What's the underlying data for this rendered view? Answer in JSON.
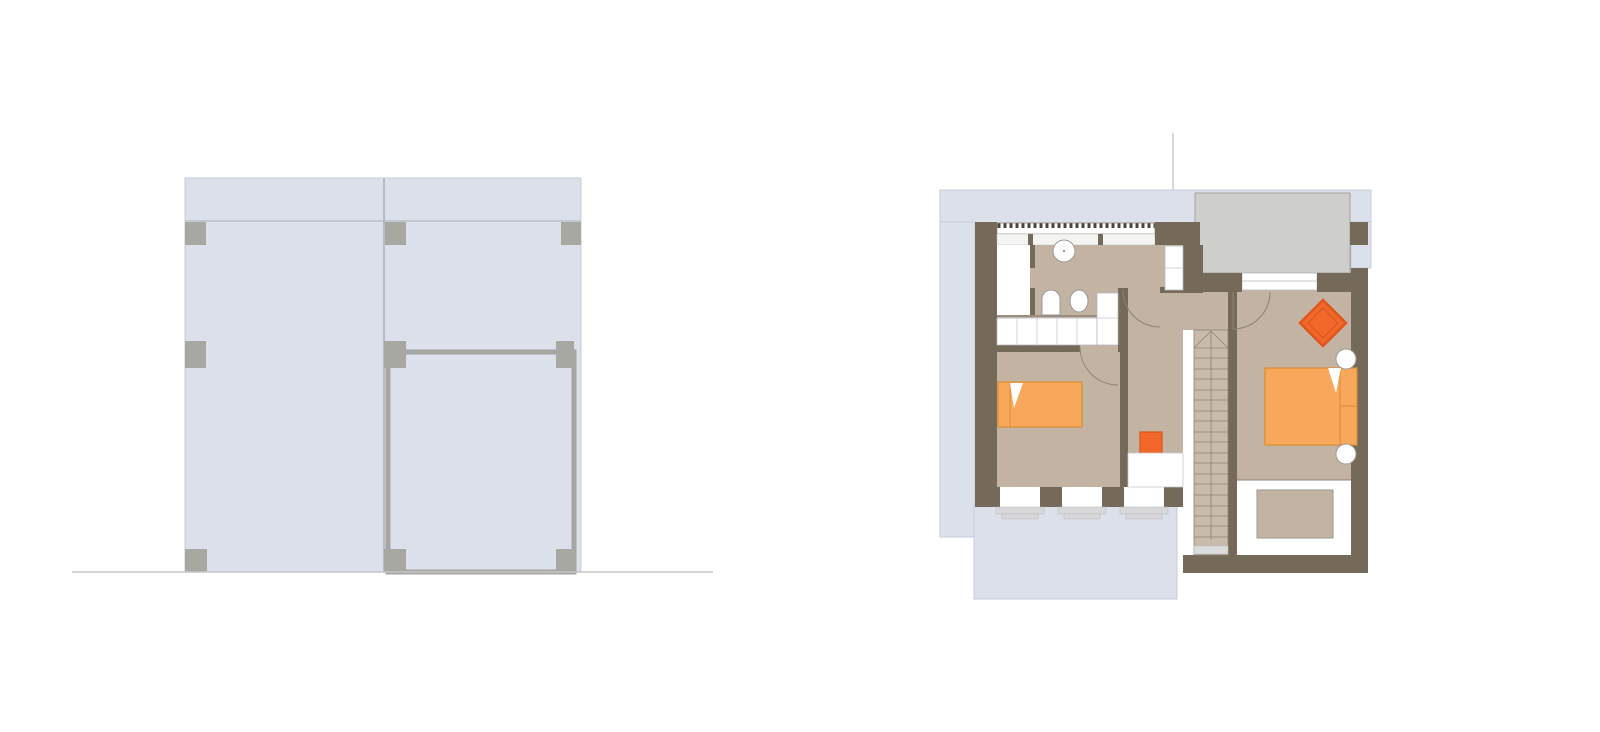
{
  "canvas": {
    "width": 1600,
    "height": 732,
    "background": "#ffffff"
  },
  "palette": {
    "blue": "#dbe0ea",
    "blueStroke": "#c6ccd9",
    "wall": "#75695a",
    "floor": "#c2b3a3",
    "stair": "#c9bbab",
    "terrace": "#cecfca",
    "terraceStroke": "#a3a39e",
    "white": "#ffffff",
    "sillGray": "#d8d8db",
    "squareGray": "#a8a8a3",
    "bedOrange": "#f7a85b",
    "bedStroke": "#de8c31",
    "brightOrange": "#f2672a",
    "brightStroke": "#d9551b",
    "thinLine": "#8d8276",
    "lightLine": "#c9c9cc",
    "fixtureStroke": "#9a9a96",
    "groundLine": "#c6c6c6",
    "frameGray": "#a6a6a2",
    "panelLine": "#a9aeb9"
  },
  "elevation": {
    "name": "building-elevation",
    "shapes": [
      {
        "n": "facade-body",
        "t": "rect",
        "x": 185,
        "y": 178,
        "w": 396,
        "h": 394,
        "f": "$blue",
        "s": "$blueStroke",
        "sw": 1
      },
      {
        "n": "facade-top-band-line",
        "t": "line",
        "x1": 185,
        "y1": 221,
        "x2": 581,
        "y2": 221,
        "s": "$panelLine",
        "sw": 1
      },
      {
        "n": "facade-panel-divider",
        "t": "line",
        "x1": 384,
        "y1": 178,
        "x2": 384,
        "y2": 572,
        "s": "$panelLine",
        "sw": 1.5
      },
      {
        "n": "facade-door-frame",
        "t": "rect",
        "x": 388,
        "y": 352,
        "w": 186,
        "h": 220,
        "f": "none",
        "s": "$frameGray",
        "sw": 5
      },
      {
        "n": "connector-square-top-left",
        "t": "rect",
        "x": 185,
        "y": 222,
        "w": 21,
        "h": 23,
        "f": "$squareGray"
      },
      {
        "n": "connector-square-top-mid",
        "t": "rect",
        "x": 385,
        "y": 222,
        "w": 21,
        "h": 23,
        "f": "$squareGray"
      },
      {
        "n": "connector-square-top-right",
        "t": "rect",
        "x": 561,
        "y": 222,
        "w": 20,
        "h": 23,
        "f": "$squareGray"
      },
      {
        "n": "connector-square-mid-left",
        "t": "rect",
        "x": 185,
        "y": 341,
        "w": 21,
        "h": 27,
        "f": "$squareGray"
      },
      {
        "n": "connector-square-mid-center",
        "t": "rect",
        "x": 384,
        "y": 341,
        "w": 22,
        "h": 27,
        "f": "$squareGray"
      },
      {
        "n": "connector-square-mid-right",
        "t": "rect",
        "x": 556,
        "y": 341,
        "w": 18,
        "h": 27,
        "f": "$squareGray"
      },
      {
        "n": "connector-square-bottom-left",
        "t": "rect",
        "x": 185,
        "y": 549,
        "w": 22,
        "h": 23,
        "f": "$squareGray"
      },
      {
        "n": "connector-square-bottom-center",
        "t": "rect",
        "x": 384,
        "y": 549,
        "w": 22,
        "h": 23,
        "f": "$squareGray"
      },
      {
        "n": "connector-square-bottom-right",
        "t": "rect",
        "x": 556,
        "y": 549,
        "w": 18,
        "h": 23,
        "f": "$squareGray"
      },
      {
        "n": "ground-line",
        "t": "line",
        "x1": 72,
        "y1": 572,
        "x2": 713,
        "y2": 572,
        "s": "$groundLine",
        "sw": 1.5
      }
    ]
  },
  "floor_plan": {
    "name": "attic-floor-plan",
    "shapes": [
      {
        "n": "roof-top-band",
        "t": "rect",
        "x": 940,
        "y": 190,
        "w": 431,
        "h": 33,
        "f": "$blue",
        "s": "$blueStroke",
        "sw": 1
      },
      {
        "n": "roof-left-column",
        "t": "rect",
        "x": 940,
        "y": 222,
        "w": 35,
        "h": 315,
        "f": "$blue",
        "s": "$blueStroke",
        "sw": 1
      },
      {
        "n": "roof-right-column",
        "t": "rect",
        "x": 1351,
        "y": 222,
        "w": 20,
        "h": 46,
        "f": "$blue",
        "s": "$blueStroke",
        "sw": 1
      },
      {
        "n": "roof-bottom-apron",
        "t": "rect",
        "x": 974,
        "y": 505,
        "w": 203,
        "h": 94,
        "f": "$blue",
        "s": "$blueStroke",
        "sw": 1
      },
      {
        "n": "survey-line",
        "t": "line",
        "x1": 1173,
        "y1": 133,
        "x2": 1173,
        "y2": 190,
        "s": "#c9cdd6",
        "sw": 1.5
      },
      {
        "n": "floor-main",
        "t": "rect",
        "x": 997,
        "y": 236,
        "w": 354,
        "h": 251,
        "f": "$floor"
      },
      {
        "n": "terrace",
        "t": "rect",
        "x": 1195,
        "y": 193,
        "w": 155,
        "h": 80,
        "f": "$terrace",
        "s": "$terraceStroke",
        "sw": 1
      },
      {
        "n": "terrace-door-sill",
        "t": "rect",
        "x": 1242,
        "y": 273,
        "w": 75,
        "h": 17,
        "f": "$white",
        "s": "#b9b9bc",
        "sw": 0.75
      },
      {
        "n": "terrace-door-line",
        "t": "line",
        "x1": 1242,
        "y1": 281,
        "x2": 1317,
        "y2": 281,
        "s": "$lightLine",
        "sw": 1
      },
      {
        "n": "wall-top-left-pier",
        "t": "rect",
        "x": 975,
        "y": 222,
        "w": 22,
        "h": 23,
        "f": "$wall"
      },
      {
        "n": "wall-top-hatch",
        "t": "rect",
        "x": 997,
        "y": 223,
        "w": 158,
        "h": 11,
        "f": "url(#hatch)",
        "s": "$thinLine",
        "sw": 0.75
      },
      {
        "n": "wall-top-sill",
        "t": "rect",
        "x": 997,
        "y": 234,
        "w": 158,
        "h": 11,
        "f": "#f4f4f2",
        "s": "#b9b9bc",
        "sw": 0.5
      },
      {
        "n": "sill-stub-1",
        "t": "rect",
        "x": 1028,
        "y": 234,
        "w": 5,
        "h": 11,
        "f": "$wall"
      },
      {
        "n": "sill-stub-2",
        "t": "rect",
        "x": 1098,
        "y": 234,
        "w": 5,
        "h": 11,
        "f": "$wall"
      },
      {
        "n": "wall-top-right-pier",
        "t": "rect",
        "x": 1155,
        "y": 222,
        "w": 45,
        "h": 23,
        "f": "$wall"
      },
      {
        "n": "wall-left",
        "t": "rect",
        "x": 975,
        "y": 245,
        "w": 22,
        "h": 242,
        "f": "$wall"
      },
      {
        "n": "wall-hall-pier",
        "t": "rect",
        "x": 1183,
        "y": 245,
        "w": 20,
        "h": 48,
        "f": "$wall"
      },
      {
        "n": "wall-under-terrace-left",
        "t": "rect",
        "x": 1200,
        "y": 273,
        "w": 42,
        "h": 19,
        "f": "$wall"
      },
      {
        "n": "wall-under-terrace-right",
        "t": "rect",
        "x": 1317,
        "y": 273,
        "w": 51,
        "h": 19,
        "f": "$wall"
      },
      {
        "n": "wall-right-pier-top",
        "t": "rect",
        "x": 1350,
        "y": 222,
        "w": 18,
        "h": 23,
        "f": "$wall"
      },
      {
        "n": "wall-right",
        "t": "rect",
        "x": 1351,
        "y": 268,
        "w": 17,
        "h": 305,
        "f": "$wall"
      },
      {
        "n": "wall-bottom-under-stairs",
        "t": "rect",
        "x": 1183,
        "y": 555,
        "w": 185,
        "h": 18,
        "f": "$wall"
      },
      {
        "n": "wall-stair-right",
        "t": "rect",
        "x": 1228,
        "y": 290,
        "w": 9,
        "h": 265,
        "f": "$wall"
      },
      {
        "n": "wall-bottom-left",
        "t": "rect",
        "x": 975,
        "y": 487,
        "w": 208,
        "h": 20,
        "f": "$wall"
      },
      {
        "n": "window-1",
        "t": "rect",
        "x": 1000,
        "y": 487,
        "w": 40,
        "h": 20,
        "f": "$white"
      },
      {
        "n": "window-1-sill",
        "t": "rect",
        "x": 996,
        "y": 507,
        "w": 48,
        "h": 7,
        "f": "$sillGray",
        "s": "#b5b5b8",
        "sw": 0.5
      },
      {
        "n": "window-1-sill-step",
        "t": "rect",
        "x": 1002,
        "y": 514,
        "w": 36,
        "h": 5,
        "f": "$sillGray",
        "s": "#b5b5b8",
        "sw": 0.5
      },
      {
        "n": "window-2",
        "t": "rect",
        "x": 1062,
        "y": 487,
        "w": 40,
        "h": 20,
        "f": "$white"
      },
      {
        "n": "window-2-sill",
        "t": "rect",
        "x": 1058,
        "y": 507,
        "w": 48,
        "h": 7,
        "f": "$sillGray",
        "s": "#b5b5b8",
        "sw": 0.5
      },
      {
        "n": "window-2-sill-step",
        "t": "rect",
        "x": 1064,
        "y": 514,
        "w": 36,
        "h": 5,
        "f": "$sillGray",
        "s": "#b5b5b8",
        "sw": 0.5
      },
      {
        "n": "window-3",
        "t": "rect",
        "x": 1124,
        "y": 487,
        "w": 40,
        "h": 20,
        "f": "$white"
      },
      {
        "n": "window-3-sill",
        "t": "rect",
        "x": 1120,
        "y": 507,
        "w": 48,
        "h": 7,
        "f": "$sillGray",
        "s": "#b5b5b8",
        "sw": 0.5
      },
      {
        "n": "window-3-sill-step",
        "t": "rect",
        "x": 1126,
        "y": 514,
        "w": 36,
        "h": 5,
        "f": "$sillGray",
        "s": "#b5b5b8",
        "sw": 0.5
      },
      {
        "n": "wall-bedroom1-top-a",
        "t": "rect",
        "x": 975,
        "y": 345,
        "w": 105,
        "h": 7,
        "f": "$wall"
      },
      {
        "n": "wall-bedroom1-top-b",
        "t": "rect",
        "x": 1118,
        "y": 345,
        "w": 10,
        "h": 7,
        "f": "$wall"
      },
      {
        "n": "wall-bedroom1-right",
        "t": "rect",
        "x": 1120,
        "y": 345,
        "w": 8,
        "h": 142,
        "f": "$wall"
      },
      {
        "n": "wall-shaft-right",
        "t": "rect",
        "x": 1118,
        "y": 288,
        "w": 10,
        "h": 57,
        "f": "$wall"
      },
      {
        "n": "wall-bath-cap",
        "t": "rect",
        "x": 1160,
        "y": 287,
        "w": 23,
        "h": 6,
        "f": "$wall"
      },
      {
        "n": "wall-bath-divider-a",
        "t": "rect",
        "x": 1030,
        "y": 245,
        "w": 5,
        "h": 23,
        "f": "$wall"
      },
      {
        "n": "wall-bath-divider-b",
        "t": "rect",
        "x": 1030,
        "y": 288,
        "w": 5,
        "h": 27,
        "f": "$wall"
      },
      {
        "n": "wall-bath-bottom-line",
        "t": "line",
        "x1": 997,
        "y1": 316,
        "x2": 1097,
        "y2": 316,
        "s": "$thinLine",
        "sw": 1.5
      },
      {
        "n": "closet-room",
        "t": "rect",
        "x": 997,
        "y": 245,
        "w": 33,
        "h": 70,
        "f": "$white"
      },
      {
        "n": "cabinet-row",
        "t": "rect",
        "x": 997,
        "y": 318,
        "w": 100,
        "h": 27,
        "f": "$white",
        "s": "#b9b9bc",
        "sw": 0.75
      },
      {
        "n": "cabinet-row-dividers",
        "t": "vlines",
        "y1": 318,
        "y2": 345,
        "xs": [
          1017,
          1037,
          1057,
          1077
        ],
        "s": "$lightLine",
        "sw": 0.75
      },
      {
        "n": "shaft-1",
        "t": "rect",
        "x": 1097,
        "y": 293,
        "w": 21,
        "h": 52,
        "f": "$white",
        "s": "#b9b9bc",
        "sw": 0.75
      },
      {
        "n": "shaft-1-divider",
        "t": "line",
        "x1": 1097,
        "y1": 318,
        "x2": 1118,
        "y2": 318,
        "s": "$lightLine",
        "sw": 0.75
      },
      {
        "n": "shaft-2",
        "t": "rect",
        "x": 1165,
        "y": 246,
        "w": 18,
        "h": 44,
        "f": "$white",
        "s": "#b9b9bc",
        "sw": 0.75
      },
      {
        "n": "shaft-2-divider",
        "t": "line",
        "x1": 1165,
        "y1": 268,
        "x2": 1183,
        "y2": 268,
        "s": "$lightLine",
        "sw": 0.75
      },
      {
        "n": "sink-basin",
        "t": "circle",
        "cx": 1064,
        "cy": 251,
        "r": 11,
        "f": "$white",
        "s": "$fixtureStroke",
        "sw": 1
      },
      {
        "n": "sink-drain-dot",
        "t": "circle",
        "cx": 1064,
        "cy": 251,
        "r": 1.2,
        "f": "$fixtureStroke"
      },
      {
        "n": "toilet-1",
        "t": "path",
        "d": "M1042,315 L1042,299 A9,9 0 0 1 1060,299 L1060,315 Z",
        "f": "$white",
        "s": "$fixtureStroke",
        "sw": 1
      },
      {
        "n": "toilet-2",
        "t": "ellipse",
        "cx": 1079,
        "cy": 301,
        "rx": 9,
        "ry": 11,
        "f": "$white",
        "s": "$fixtureStroke",
        "sw": 1
      },
      {
        "n": "stair-side-strip",
        "t": "rect",
        "x": 1183,
        "y": 330,
        "w": 11,
        "h": 225,
        "f": "$white"
      },
      {
        "n": "stairs-body",
        "t": "rect",
        "x": 1194,
        "y": 330,
        "w": 34,
        "h": 225,
        "f": "$stair",
        "s": "$thinLine",
        "sw": 0.8
      },
      {
        "n": "stair-bottom-tread",
        "t": "rect",
        "x": 1194,
        "y": 546,
        "w": 34,
        "h": 8,
        "f": "#dcdcdc",
        "s": "#b9b9bc",
        "sw": 0.5
      },
      {
        "n": "stair-center-stringer",
        "t": "line",
        "x1": 1211,
        "y1": 331,
        "x2": 1211,
        "y2": 540,
        "s": "$thinLine",
        "sw": 0.8
      },
      {
        "n": "stair-winder-a",
        "t": "line",
        "x1": 1194,
        "y1": 348,
        "x2": 1211,
        "y2": 331,
        "s": "$thinLine",
        "sw": 0.8
      },
      {
        "n": "stair-winder-b",
        "t": "line",
        "x1": 1211,
        "y1": 331,
        "x2": 1228,
        "y2": 348,
        "s": "$thinLine",
        "sw": 0.8
      },
      {
        "n": "stair-treads",
        "t": "hlines",
        "x1": 1194,
        "x2": 1228,
        "ys": [
          348,
          358,
          369,
          379,
          390,
          400,
          411,
          421,
          432,
          442,
          453,
          463,
          474,
          484,
          495,
          506,
          516,
          526,
          537
        ],
        "s": "$thinLine",
        "sw": 0.8
      },
      {
        "n": "door-arc-bedroom1",
        "t": "path",
        "d": "M1080,347 A38,38 0 0 0 1118,385",
        "f": "none",
        "s": "$thinLine",
        "sw": 1
      },
      {
        "n": "door-arc-bathroom",
        "t": "path",
        "d": "M1123,290 A37,37 0 0 0 1160,327",
        "f": "none",
        "s": "$thinLine",
        "sw": 1
      },
      {
        "n": "door-leaf-bedroom2",
        "t": "line",
        "x1": 1233,
        "y1": 292,
        "x2": 1233,
        "y2": 329,
        "s": "$thinLine",
        "sw": 1
      },
      {
        "n": "door-arc-bedroom2",
        "t": "path",
        "d": "M1233,329 A37,37 0 0 0 1270,292",
        "f": "none",
        "s": "$thinLine",
        "sw": 1
      },
      {
        "n": "loggia",
        "t": "rect",
        "x": 1237,
        "y": 480,
        "w": 114,
        "h": 75,
        "f": "$white"
      },
      {
        "n": "loggia-top-line",
        "t": "line",
        "x1": 1237,
        "y1": 480,
        "x2": 1351,
        "y2": 480,
        "s": "$thinLine",
        "sw": 1
      },
      {
        "n": "loggia-rug",
        "t": "rect",
        "x": 1257,
        "y": 490,
        "w": 76,
        "h": 48,
        "f": "$floor",
        "s": "#98988f",
        "sw": 1
      },
      {
        "n": "bed-single",
        "t": "rect",
        "x": 998,
        "y": 382,
        "w": 84,
        "h": 45,
        "f": "$bedOrange",
        "s": "$bedStroke",
        "sw": 1.2
      },
      {
        "n": "bed-single-head-line",
        "t": "line",
        "x1": 1010,
        "y1": 382,
        "x2": 1010,
        "y2": 427,
        "s": "$bedStroke",
        "sw": 1
      },
      {
        "n": "bed-single-pillow-fold",
        "t": "poly",
        "pts": "1010,383 1023,383 1014,408",
        "f": "$white"
      },
      {
        "n": "stool",
        "t": "rect",
        "x": 1140,
        "y": 432,
        "w": 22,
        "h": 22,
        "f": "$brightOrange",
        "s": "$brightStroke",
        "sw": 1.2
      },
      {
        "n": "desk",
        "t": "rect",
        "x": 1128,
        "y": 453,
        "w": 55,
        "h": 34,
        "f": "$white",
        "s": "$lightLine",
        "sw": 0.75
      },
      {
        "n": "bed-double",
        "t": "rect",
        "x": 1265,
        "y": 368,
        "w": 92,
        "h": 77,
        "f": "$bedOrange",
        "s": "$bedStroke",
        "sw": 1.2
      },
      {
        "n": "bed-double-head-line",
        "t": "line",
        "x1": 1340,
        "y1": 368,
        "x2": 1340,
        "y2": 445,
        "s": "$bedStroke",
        "sw": 1
      },
      {
        "n": "bed-double-mid-line",
        "t": "line",
        "x1": 1340,
        "y1": 406,
        "x2": 1357,
        "y2": 406,
        "s": "$bedStroke",
        "sw": 1
      },
      {
        "n": "bed-double-pillow-fold",
        "t": "poly",
        "pts": "1328,368 1341,368 1336,393",
        "f": "$white"
      },
      {
        "n": "nightstand-1",
        "t": "circle",
        "cx": 1346,
        "cy": 359,
        "r": 10,
        "f": "$white",
        "s": "$fixtureStroke",
        "sw": 1
      },
      {
        "n": "nightstand-2",
        "t": "circle",
        "cx": 1346,
        "cy": 454,
        "r": 10,
        "f": "$white",
        "s": "$fixtureStroke",
        "sw": 1
      },
      {
        "n": "chair-diamond-outer",
        "t": "poly",
        "pts": "1323,300 1346,323 1323,346 1300,323",
        "f": "$brightOrange",
        "s": "#e0551c",
        "sw": 2.5
      },
      {
        "n": "chair-diamond-inner",
        "t": "poly",
        "pts": "1323,308 1338,323 1323,338 1308,323",
        "f": "none",
        "s": "$brightStroke",
        "sw": 1
      }
    ]
  }
}
